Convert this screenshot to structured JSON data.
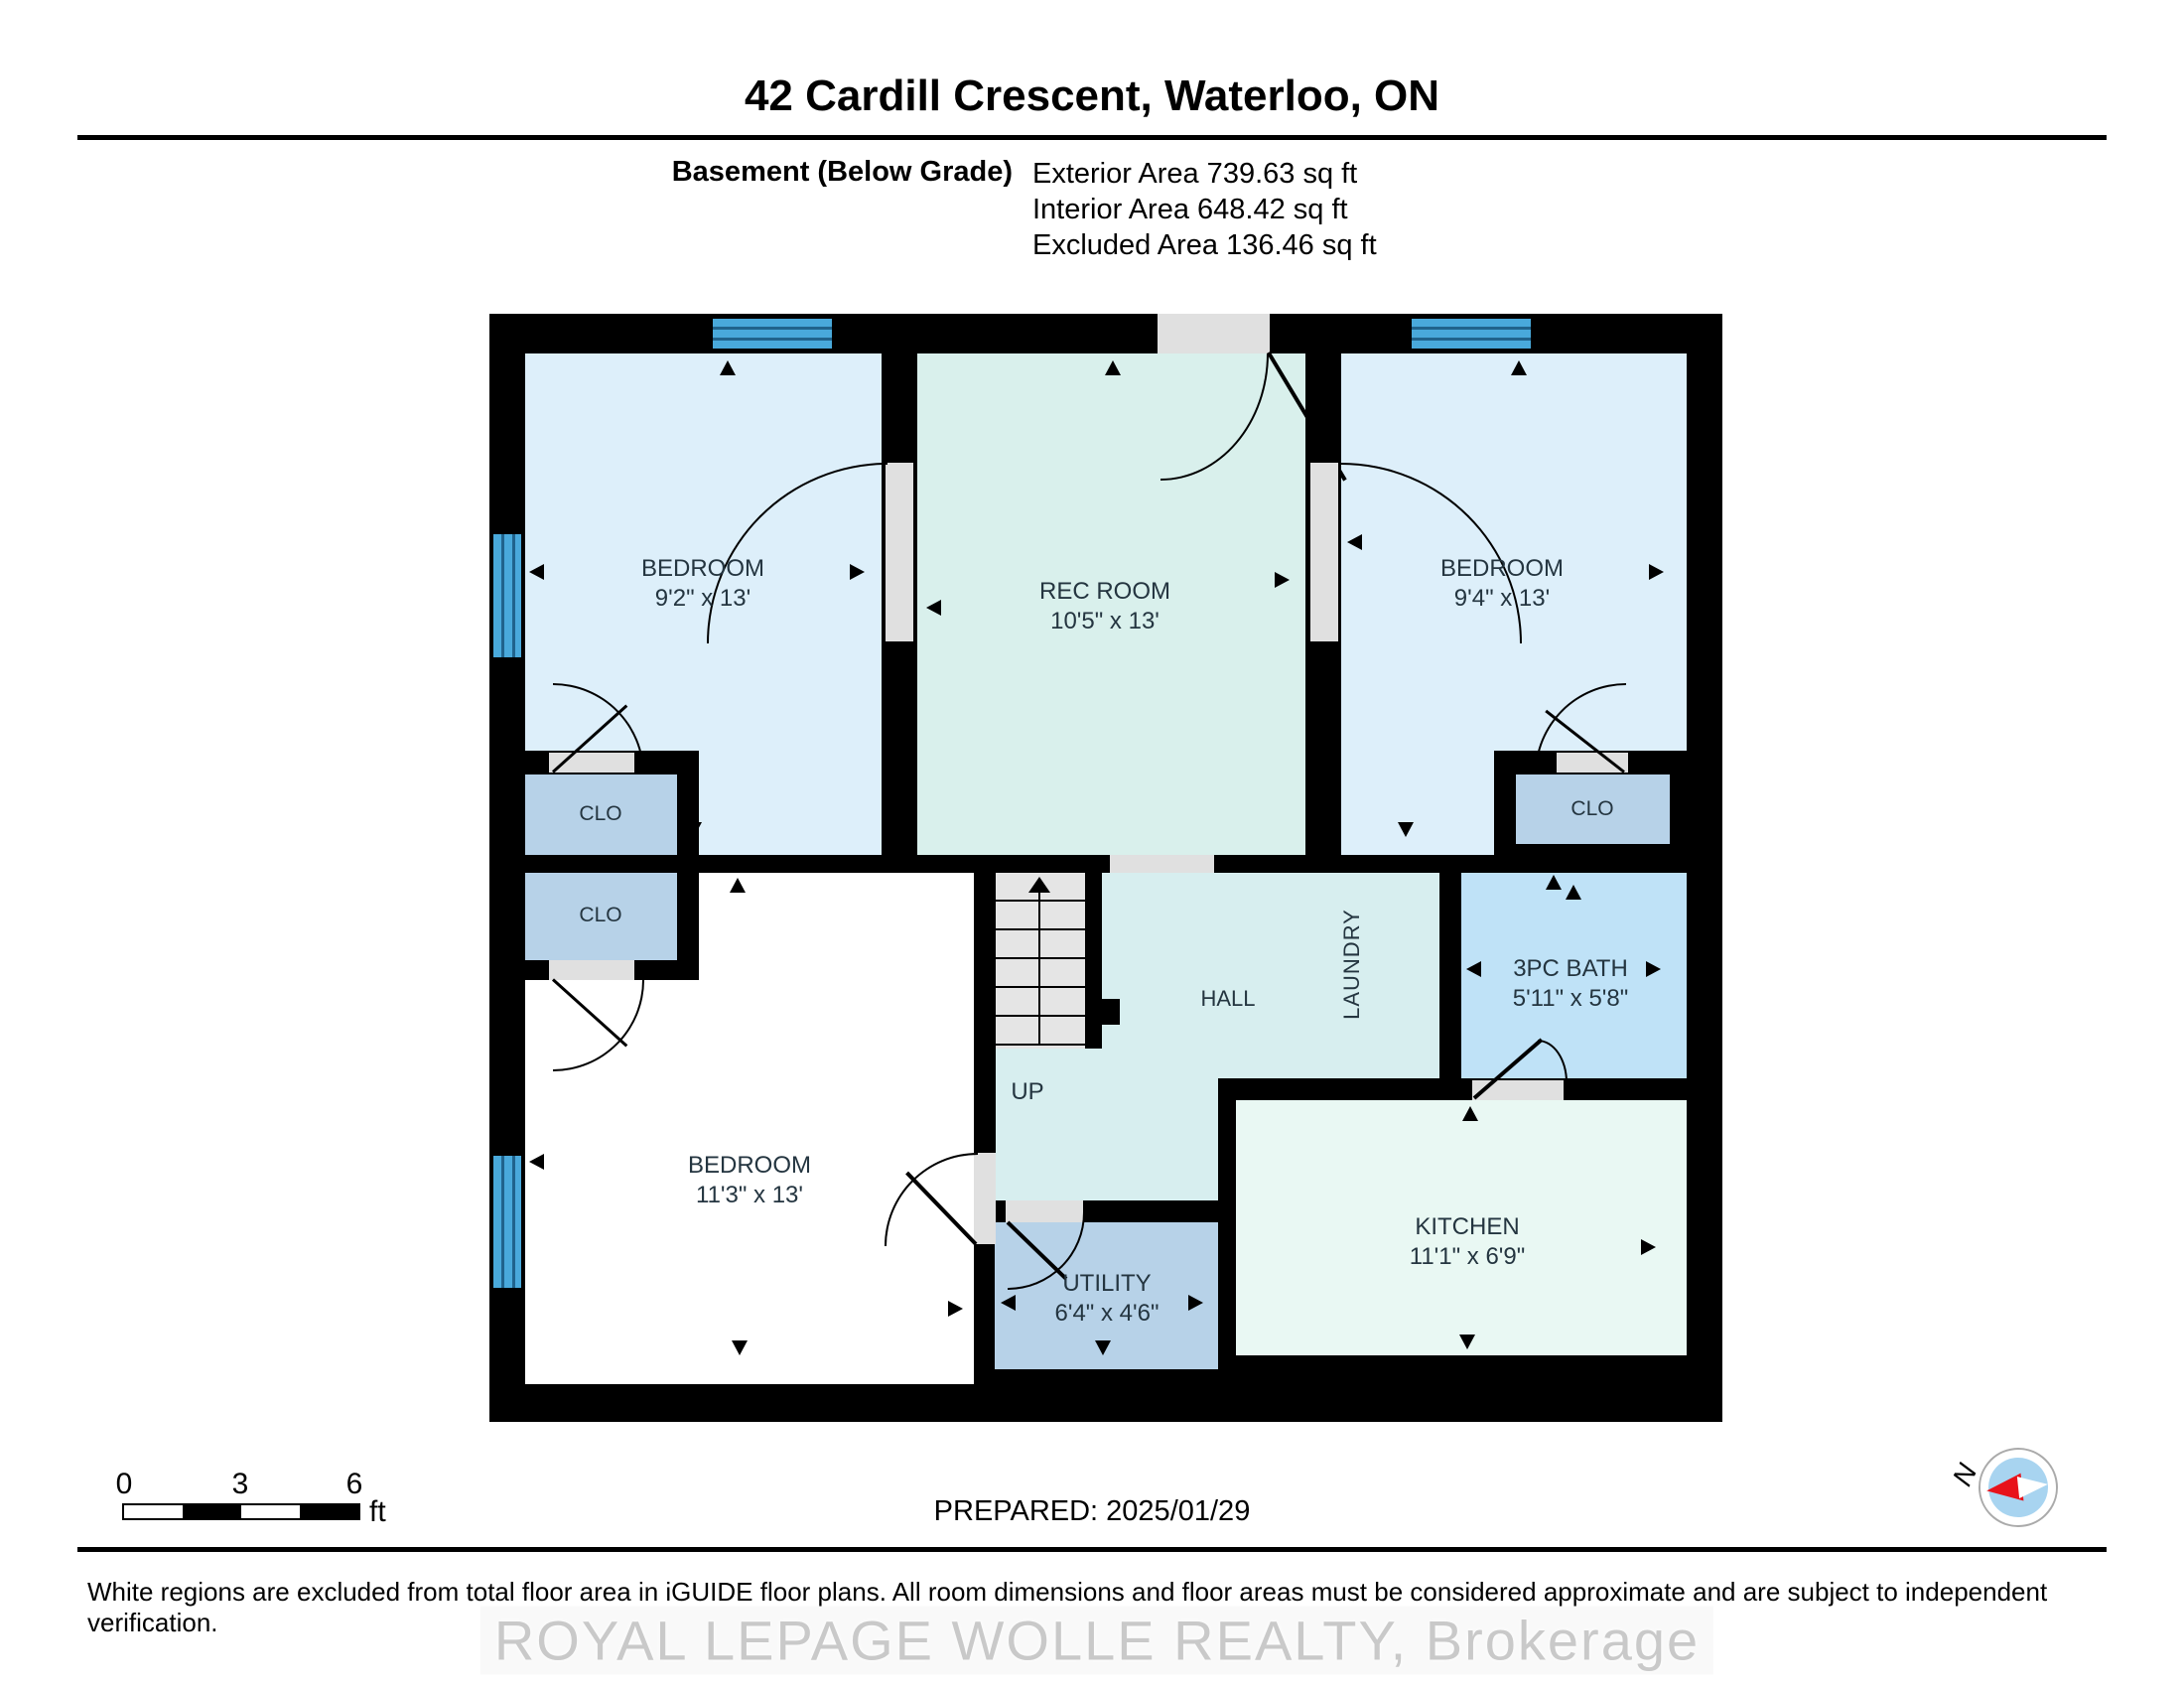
{
  "header": {
    "title": "42 Cardill Crescent, Waterloo, ON",
    "floor_label": "Basement (Below Grade)",
    "areas": {
      "exterior": "Exterior Area 739.63 sq ft",
      "interior": "Interior Area 648.42 sq ft",
      "excluded": "Excluded Area 136.46 sq ft"
    }
  },
  "plan": {
    "rooms": {
      "bedroom_top_left": {
        "name": "BEDROOM",
        "dims": "9'2\" x 13'"
      },
      "rec_room": {
        "name": "REC ROOM",
        "dims": "10'5\" x 13'"
      },
      "bedroom_top_right": {
        "name": "BEDROOM",
        "dims": "9'4\" x 13'"
      },
      "bedroom_bottom_left": {
        "name": "BEDROOM",
        "dims": "11'3\" x 13'"
      },
      "bath": {
        "name": "3PC BATH",
        "dims": "5'11\" x 5'8\""
      },
      "kitchen": {
        "name": "KITCHEN",
        "dims": "11'1\" x 6'9\""
      },
      "utility": {
        "name": "UTILITY",
        "dims": "6'4\" x 4'6\""
      },
      "hall": {
        "name": "HALL"
      },
      "laundry": {
        "name": "LAUNDRY"
      },
      "closet_top_left": {
        "name": "CLO"
      },
      "closet_mid_left": {
        "name": "CLO"
      },
      "closet_top_right": {
        "name": "CLO"
      },
      "stairs": {
        "label": "UP"
      }
    },
    "colors": {
      "wall": "#000000",
      "bedroom_fill": "#ddeffa",
      "rec_fill": "#d9f0ec",
      "hall_fill": "#d7eeef",
      "closet_fill": "#b7d2e8",
      "bath_fill": "#bfe2f7",
      "kitchen_fill": "#e9f8f3",
      "excluded_fill": "#ffffff",
      "window_blue": "#49a9db",
      "door_gray": "#e0e0e0",
      "stairs_gray": "#e5e5e5"
    }
  },
  "footer": {
    "scale": {
      "ticks": [
        "0",
        "3",
        "6"
      ],
      "unit": "ft"
    },
    "prepared": "PREPARED: 2025/01/29",
    "compass_label": "N",
    "disclaimer": "White regions are excluded from total floor area in iGUIDE floor plans. All room dimensions and floor areas must be considered approximate and are subject to independent verification.",
    "watermark": "ROYAL LEPAGE WOLLE REALTY, Brokerage"
  }
}
